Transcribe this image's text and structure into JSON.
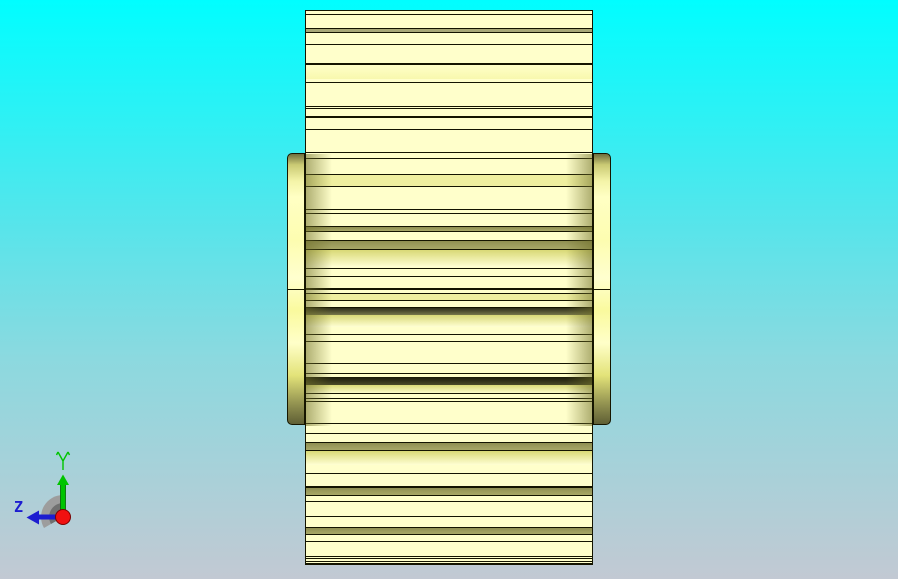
{
  "viewport": {
    "width": 898,
    "height": 579,
    "background_top": "#00feff",
    "background_mid1": "#55e5eb",
    "background_mid2": "#8cd9df",
    "background_bottom": "#c2c9d3"
  },
  "triad": {
    "y_label": "Y",
    "z_label": "Z",
    "y_color": "#00c400",
    "y_edge": "#006600",
    "z_color": "#1d1dd0",
    "z_edge": "#00007a",
    "origin_color": "#f01010",
    "origin_edge": "#7a0000",
    "shadow_outer": "#9d9d9d",
    "shadow_inner": "#707070"
  },
  "model": {
    "body": {
      "x": 305,
      "y": 10,
      "w": 288,
      "h": 555,
      "base_color": "#ffffcb",
      "outline": "#141400"
    },
    "flange": {
      "left_x": 287,
      "right_x": 593,
      "y": 153,
      "w": 18,
      "h": 272,
      "divider_y": 135
    },
    "disc_shade": {
      "y": 143,
      "h": 272
    },
    "stripes": [
      {
        "y": 3,
        "h": 1,
        "c": "line"
      },
      {
        "y": 17,
        "h": 1,
        "c": "line"
      },
      {
        "y": 18,
        "h": 3,
        "c": "gray"
      },
      {
        "y": 21,
        "h": 1,
        "c": "line"
      },
      {
        "y": 33,
        "h": 1,
        "c": "line"
      },
      {
        "y": 52,
        "h": 2,
        "c": "line"
      },
      {
        "y": 54,
        "h": 14,
        "c": "bright2"
      },
      {
        "y": 71,
        "h": 1,
        "c": "line"
      },
      {
        "y": 95,
        "h": 1,
        "c": "line"
      },
      {
        "y": 97,
        "h": 1,
        "c": "line"
      },
      {
        "y": 105,
        "h": 2,
        "c": "line"
      },
      {
        "y": 118,
        "h": 1,
        "c": "line"
      },
      {
        "y": 141,
        "h": 1,
        "c": "line"
      },
      {
        "y": 147,
        "h": 1,
        "c": "line"
      },
      {
        "y": 163,
        "h": 1,
        "c": "line"
      },
      {
        "y": 164,
        "h": 11,
        "c": "khaki"
      },
      {
        "y": 175,
        "h": 1,
        "c": "line"
      },
      {
        "y": 198,
        "h": 1,
        "c": "line"
      },
      {
        "y": 202,
        "h": 1,
        "c": "line"
      },
      {
        "y": 215,
        "h": 1,
        "c": "line"
      },
      {
        "y": 216,
        "h": 4,
        "c": "olive"
      },
      {
        "y": 220,
        "h": 1,
        "c": "line"
      },
      {
        "y": 229,
        "h": 1,
        "c": "line"
      },
      {
        "y": 230,
        "h": 8,
        "c": "olive"
      },
      {
        "y": 238,
        "h": 1,
        "c": "line"
      },
      {
        "y": 239,
        "h": 17,
        "c": "bright"
      },
      {
        "y": 257,
        "h": 1,
        "c": "line"
      },
      {
        "y": 265,
        "h": 1,
        "c": "line"
      },
      {
        "y": 277,
        "h": 2,
        "c": "line"
      },
      {
        "y": 282,
        "h": 1,
        "c": "line"
      },
      {
        "y": 283,
        "h": 6,
        "c": "khaki"
      },
      {
        "y": 289,
        "h": 1,
        "c": "line"
      },
      {
        "y": 296,
        "h": 1,
        "c": "line"
      },
      {
        "y": 297,
        "h": 7,
        "c": "darkolive"
      },
      {
        "y": 304,
        "h": 12,
        "c": "bright"
      },
      {
        "y": 323,
        "h": 1,
        "c": "line"
      },
      {
        "y": 330,
        "h": 1,
        "c": "line"
      },
      {
        "y": 352,
        "h": 1,
        "c": "line"
      },
      {
        "y": 362,
        "h": 1,
        "c": "line"
      },
      {
        "y": 366,
        "h": 8,
        "c": "dark"
      },
      {
        "y": 374,
        "h": 9,
        "c": "bright"
      },
      {
        "y": 382,
        "h": 1,
        "c": "line"
      },
      {
        "y": 387,
        "h": 1,
        "c": "line"
      },
      {
        "y": 390,
        "h": 1,
        "c": "line"
      },
      {
        "y": 412,
        "h": 1,
        "c": "line"
      },
      {
        "y": 422,
        "h": 1,
        "c": "line"
      },
      {
        "y": 431,
        "h": 1,
        "c": "line"
      },
      {
        "y": 432,
        "h": 7,
        "c": "olive"
      },
      {
        "y": 439,
        "h": 1,
        "c": "line"
      },
      {
        "y": 440,
        "h": 14,
        "c": "bright"
      },
      {
        "y": 462,
        "h": 1,
        "c": "line"
      },
      {
        "y": 475,
        "h": 2,
        "c": "line"
      },
      {
        "y": 477,
        "h": 7,
        "c": "olive"
      },
      {
        "y": 484,
        "h": 1,
        "c": "line"
      },
      {
        "y": 490,
        "h": 1,
        "c": "line"
      },
      {
        "y": 505,
        "h": 1,
        "c": "line"
      },
      {
        "y": 516,
        "h": 1,
        "c": "line"
      },
      {
        "y": 517,
        "h": 6,
        "c": "olive"
      },
      {
        "y": 523,
        "h": 1,
        "c": "line"
      },
      {
        "y": 530,
        "h": 1,
        "c": "line"
      },
      {
        "y": 545,
        "h": 1,
        "c": "line"
      },
      {
        "y": 547,
        "h": 1,
        "c": "line"
      },
      {
        "y": 550,
        "h": 1,
        "c": "line"
      },
      {
        "y": 552,
        "h": 2,
        "c": "line"
      }
    ]
  }
}
